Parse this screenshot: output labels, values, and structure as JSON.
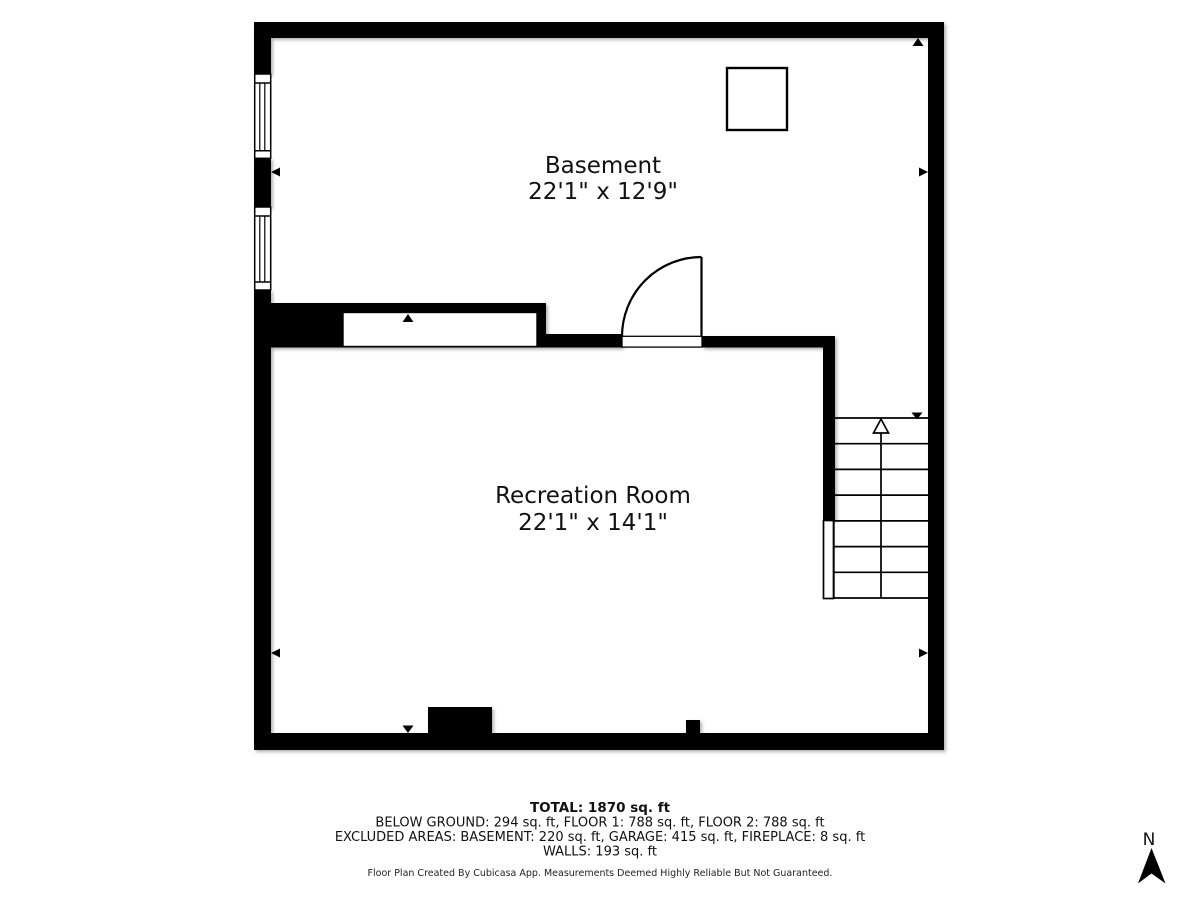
{
  "floorplan": {
    "rooms": [
      {
        "name": "Basement",
        "dims": "22'1\" x 12'9\""
      },
      {
        "name": "Recreation Room",
        "dims": "22'1\" x 14'1\""
      }
    ],
    "summary": {
      "total": "TOTAL: 1870 sq. ft",
      "below_ground": "BELOW GROUND: 294 sq. ft, FLOOR 1: 788 sq. ft, FLOOR 2: 788 sq. ft",
      "excluded": "EXCLUDED AREAS: BASEMENT: 220 sq. ft, GARAGE: 415 sq. ft, FIREPLACE: 8 sq. ft",
      "walls": "WALLS: 193 sq. ft"
    },
    "disclaimer": "Floor Plan Created By Cubicasa App. Measurements Deemed Highly Reliable But Not Guaranteed.",
    "compass": {
      "label": "N"
    },
    "colors": {
      "wall": "#000000",
      "background": "#ffffff",
      "text": "#111111"
    }
  }
}
